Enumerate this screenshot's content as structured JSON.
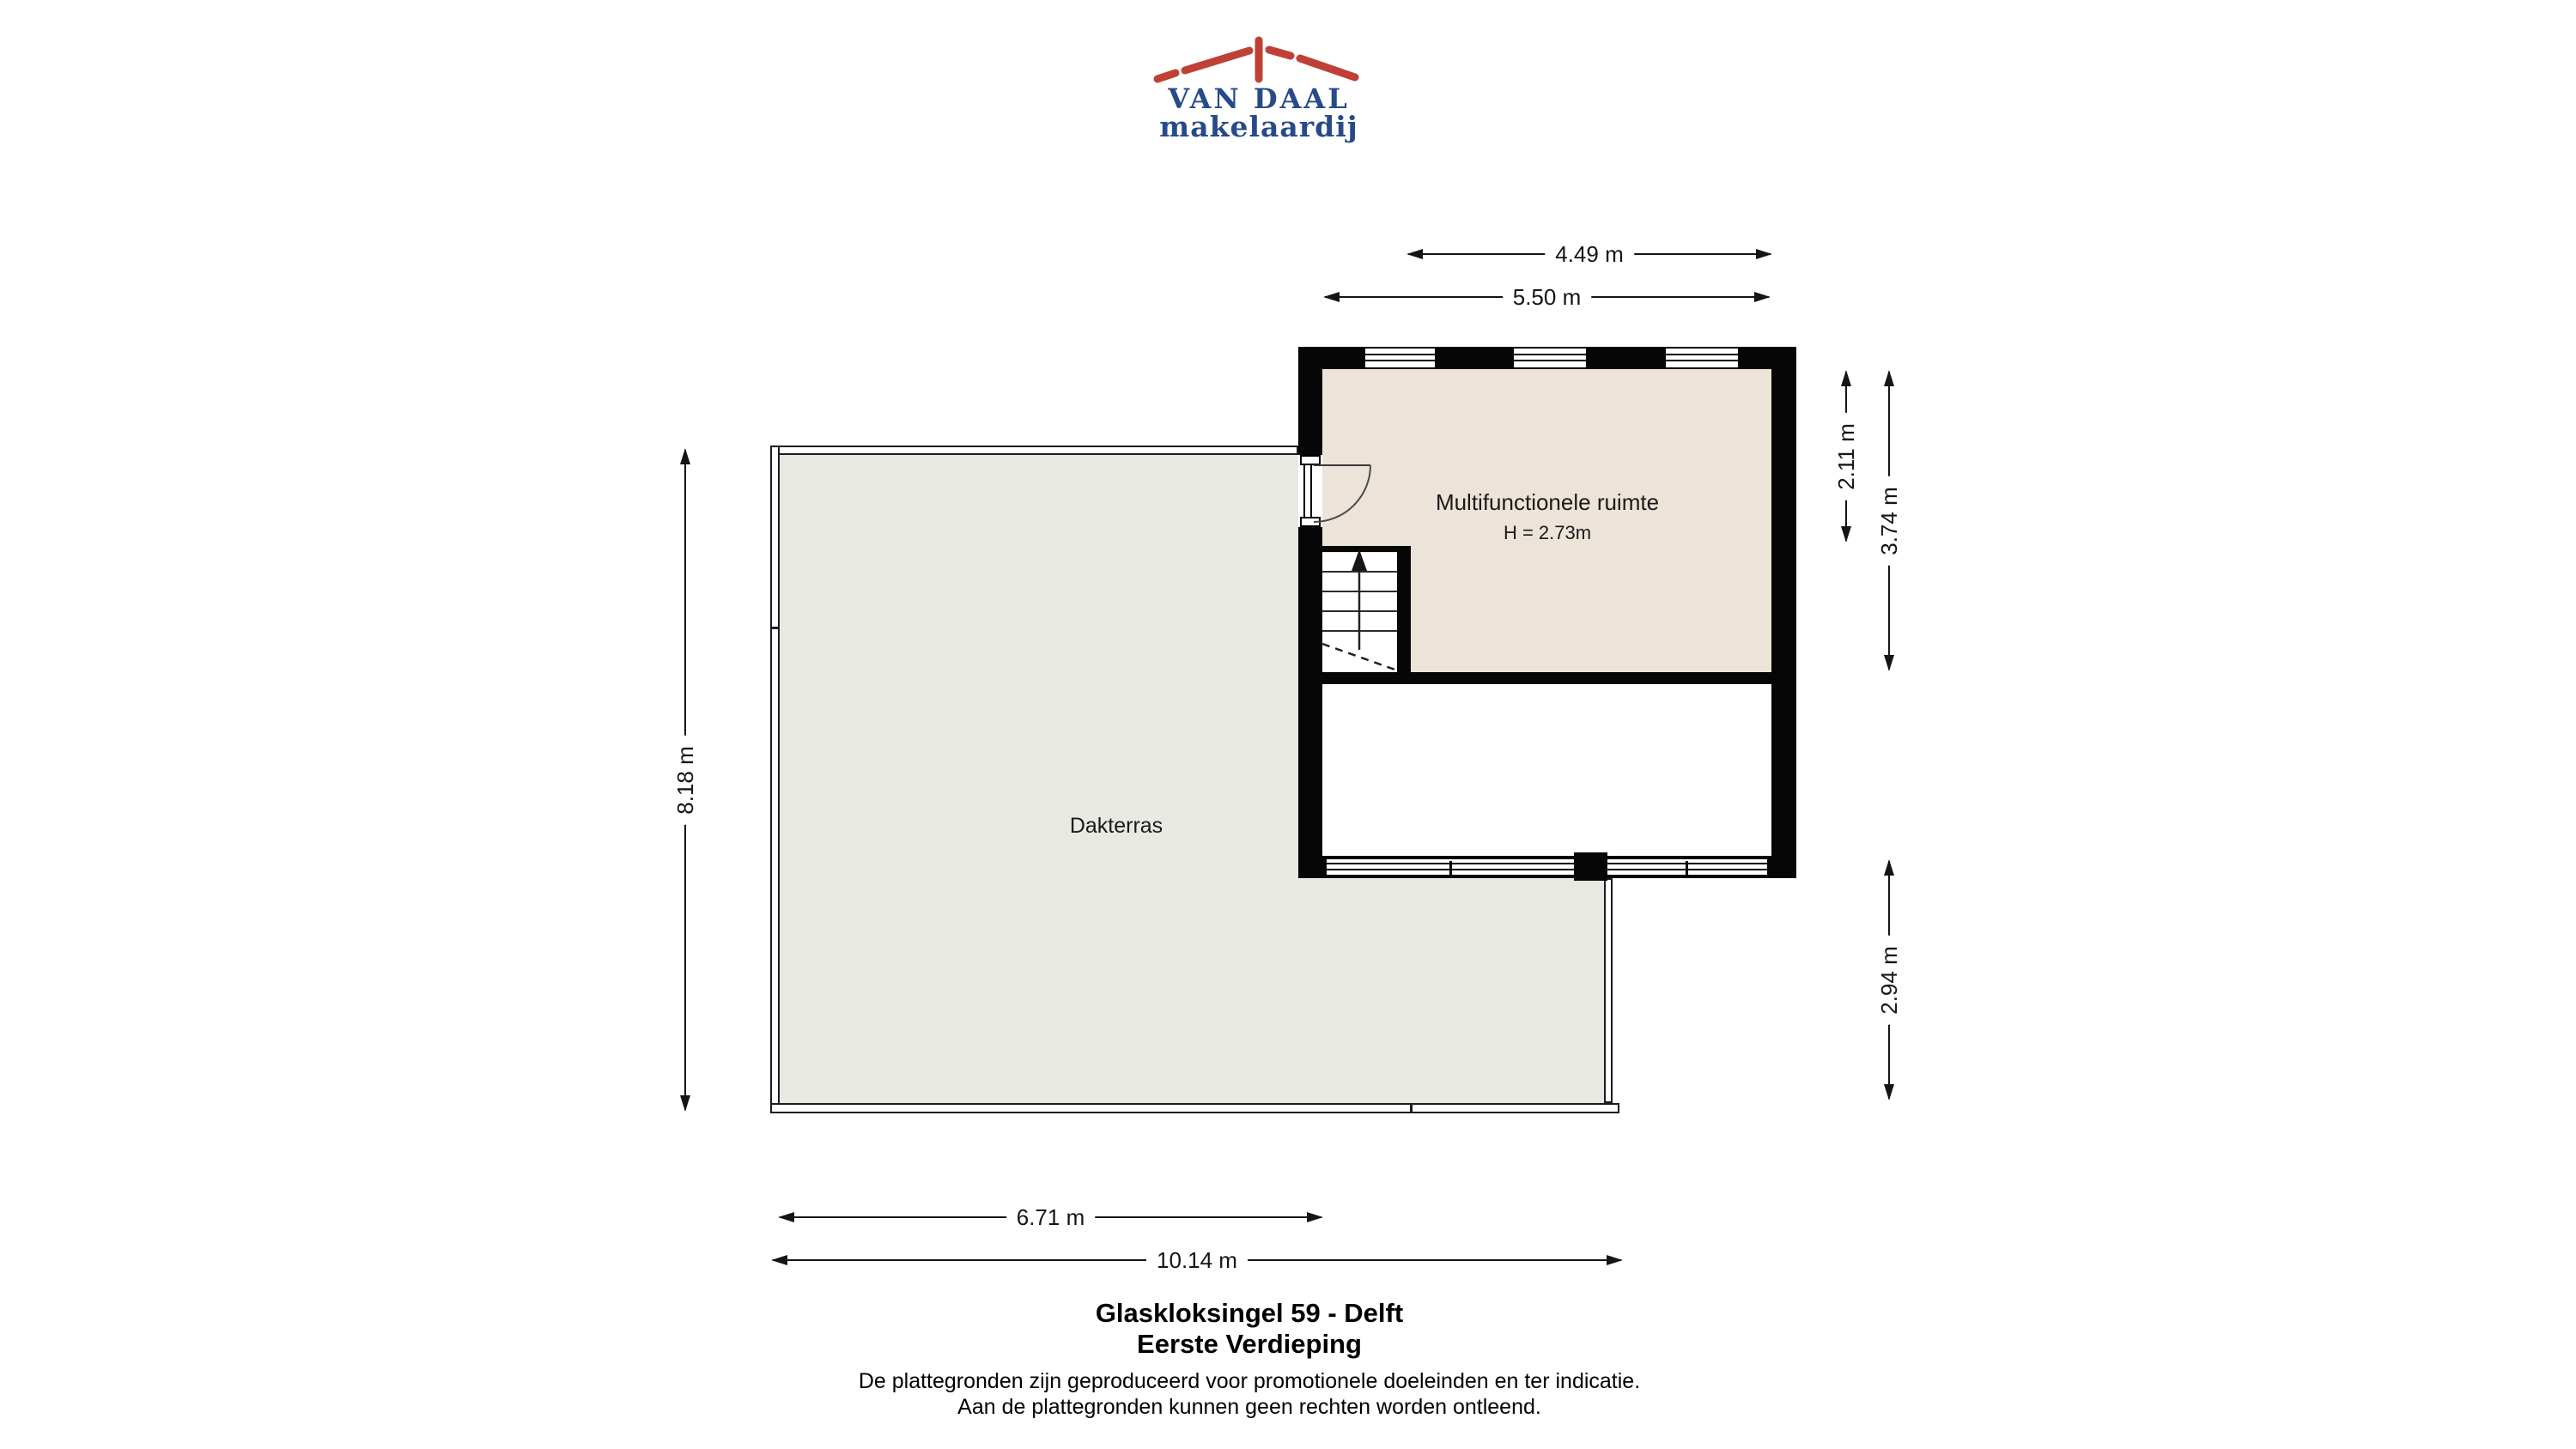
{
  "logo": {
    "title": "VAN DAAL",
    "subtitle": "makelaardij",
    "colors": {
      "brand_blue": "#274a89",
      "brand_red": "#bf4136"
    }
  },
  "plan": {
    "wall_color": "#060606",
    "multifunctionele_ruimte": {
      "label": "Multifunctionele ruimte",
      "height_label": "H = 2.73m",
      "floor_color": "#ece3d9"
    },
    "dakterras": {
      "label": "Dakterras",
      "floor_color": "#e7e9e2"
    }
  },
  "dimensions": {
    "top_inner": "4.49 m",
    "top_outer": "5.50 m",
    "right_upper_inner": "2.11 m",
    "right_upper_outer": "3.74 m",
    "right_lower": "2.94 m",
    "left": "8.18 m",
    "bottom_inner": "6.71 m",
    "bottom_outer": "10.14 m"
  },
  "footer": {
    "address": "Glaskloksingel 59 - Delft",
    "floor": "Eerste Verdieping",
    "disclaimer1": "De plattegronden zijn geproduceerd voor promotionele doeleinden en ter indicatie.",
    "disclaimer2": "Aan de plattegronden kunnen geen rechten worden ontleend."
  }
}
